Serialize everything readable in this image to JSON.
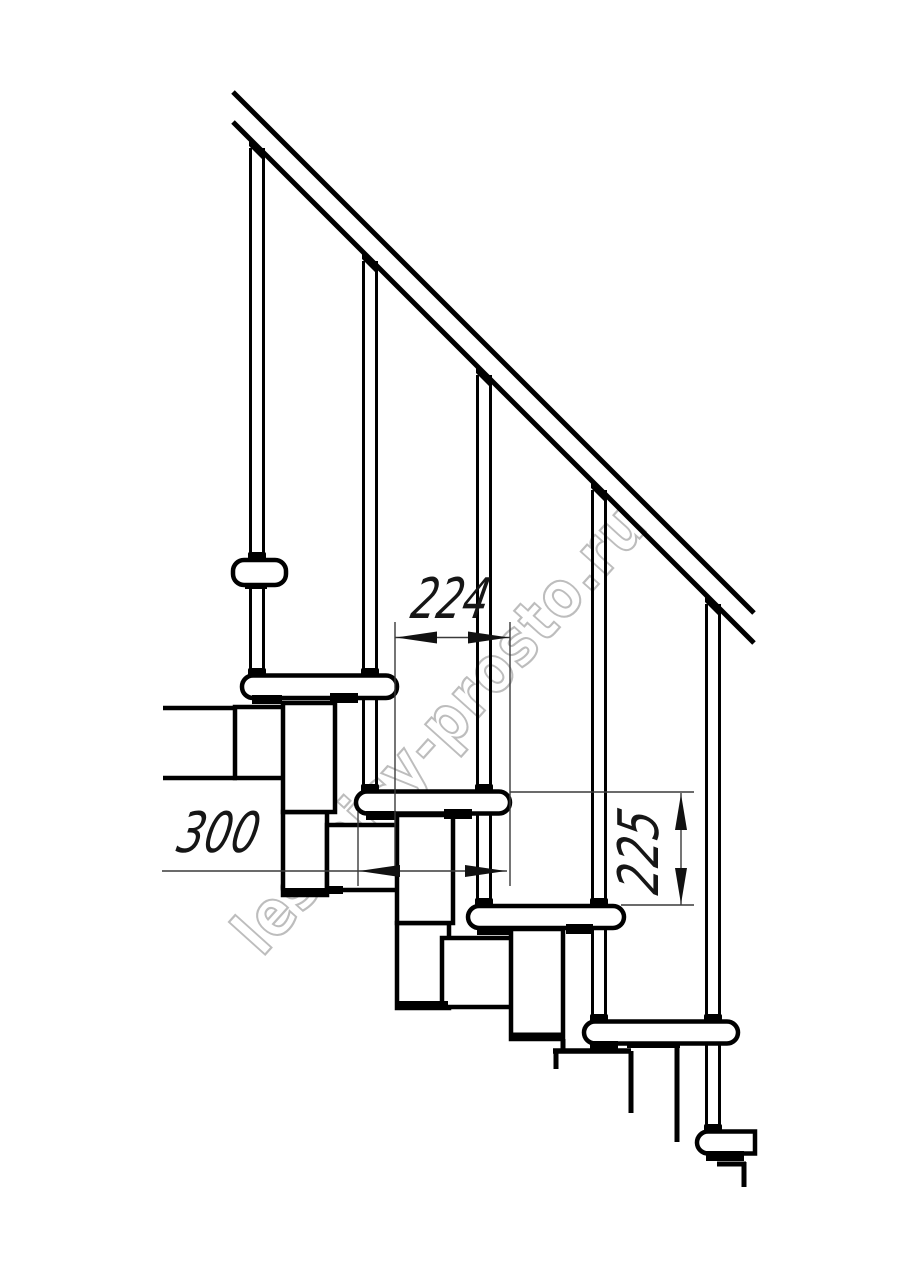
{
  "diagram": {
    "type": "technical-drawing",
    "subject": "modular staircase side elevation with railing",
    "dimensions": {
      "step_run": "224",
      "tread_depth": "300",
      "riser_height": "225"
    },
    "watermark": "lestnicy-prosto.ru",
    "colors": {
      "line": "#000000",
      "dim_line": "#3a3a3a",
      "watermark_outline": "#bdbdbd",
      "background": "#ffffff"
    }
  }
}
